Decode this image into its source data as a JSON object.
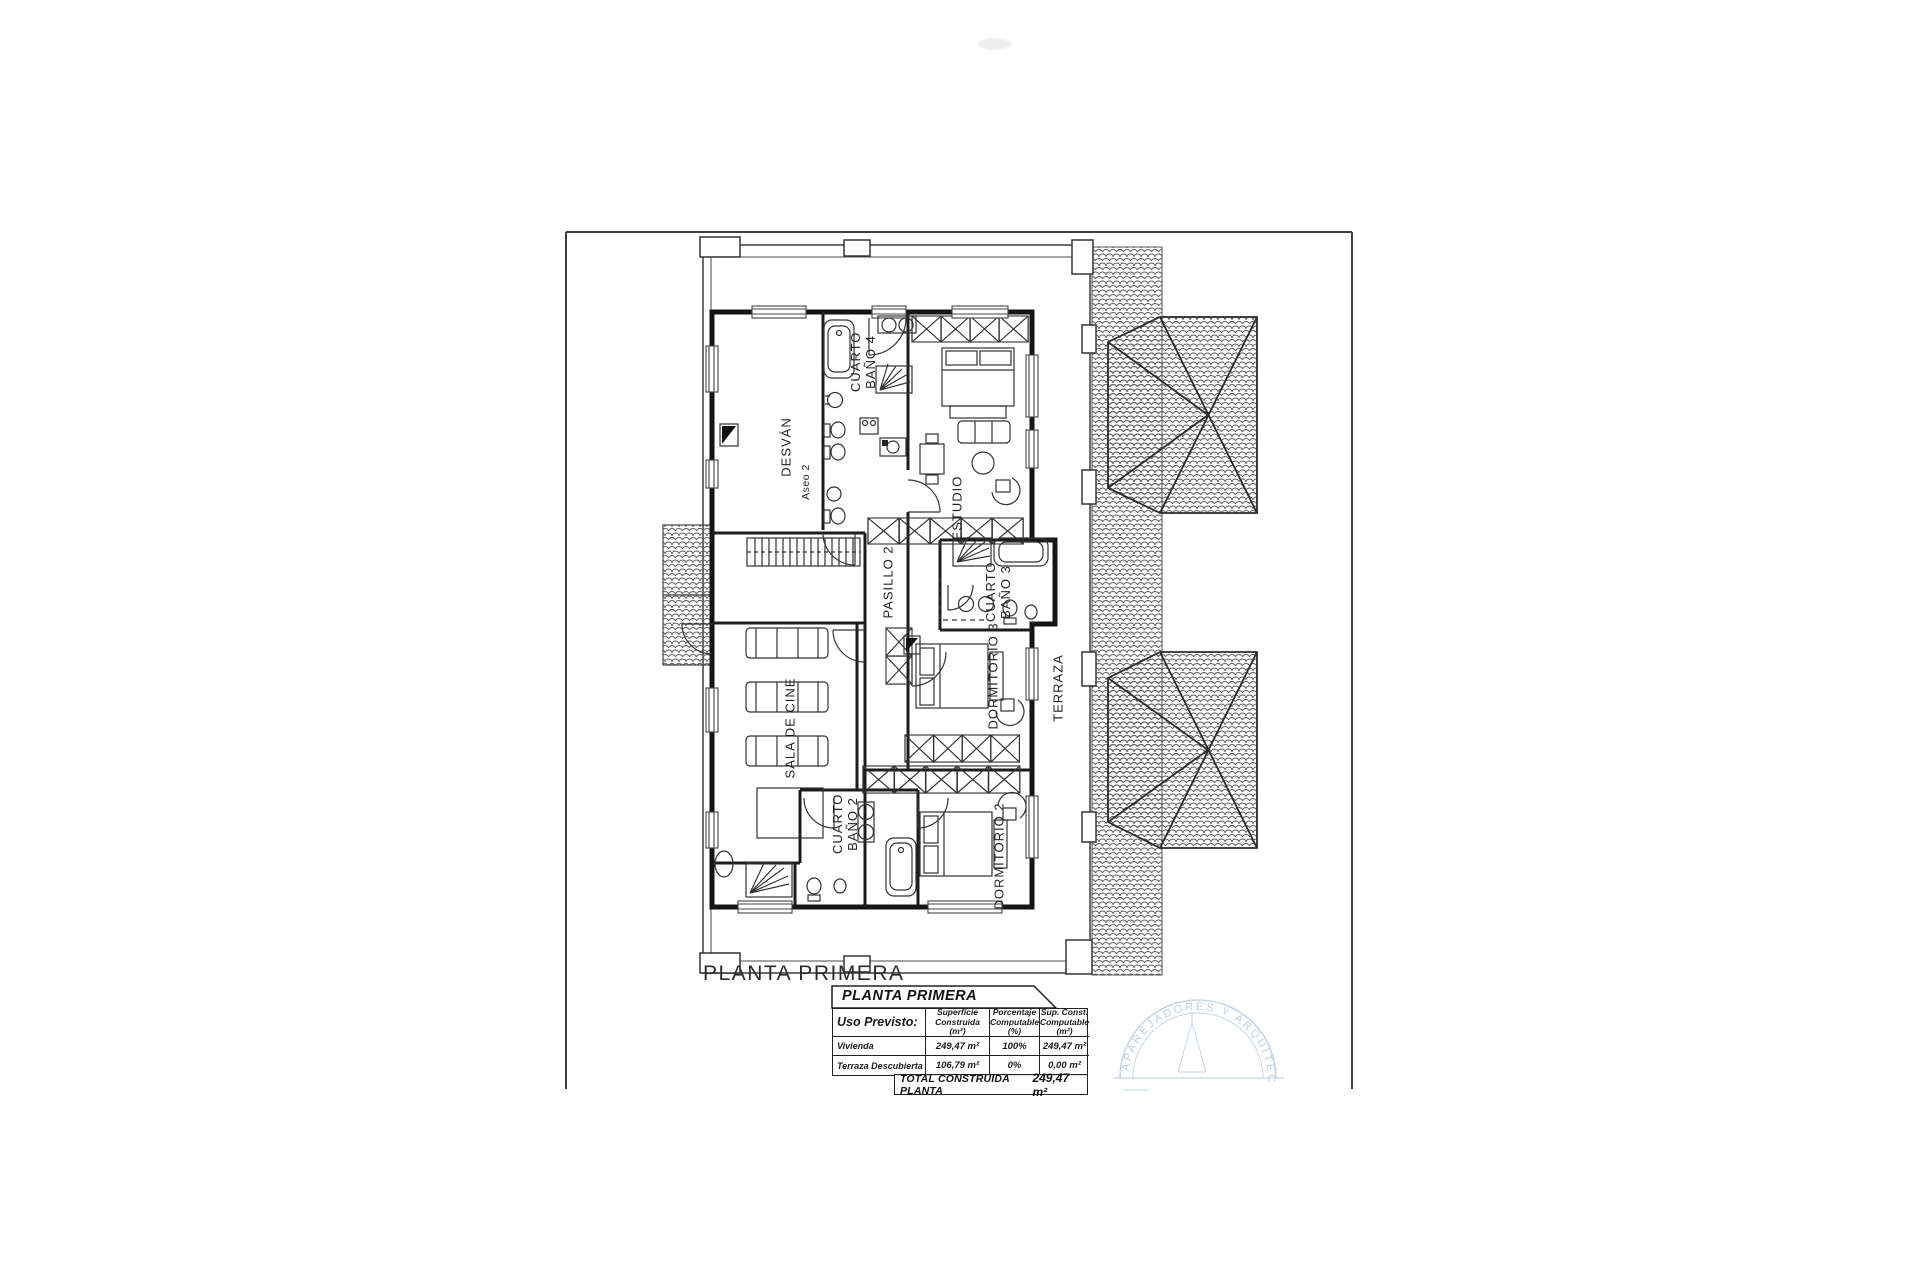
{
  "caption": "PLANTA PRIMERA",
  "rooms": {
    "desvan": "DESVÁN",
    "cuarto_bano_4": "CUARTO BAÑO 4",
    "aseo_2": "Aseo 2",
    "estudio": "ESTUDIO",
    "pasillo_2": "PASILLO 2",
    "cuarto_bano_3": "CUARTO BAÑO 3",
    "dormitorio_3": "DORMITORIO 3",
    "terraza": "TERRAZA",
    "sala_de_cine": "SALA DE CINE",
    "cuarto_bano_2": "CUARTO BAÑO 2",
    "dormitorio_2": "DORMITORIO 2"
  },
  "summary_table": {
    "title": "PLANTA PRIMERA",
    "col_headers": {
      "uso": "Uso Previsto:",
      "superficie": "Superficie Construida (m²)",
      "porcentaje": "Porcentaje Computable (%)",
      "sup_const": "Sup. Const. Computable (m²)"
    },
    "rows": [
      {
        "uso": "Vivienda",
        "superficie": "249,47 m²",
        "porcentaje": "100%",
        "sup_const": "249,47 m²"
      },
      {
        "uso": "Terraza Descubierta",
        "superficie": "106,79 m²",
        "porcentaje": "0%",
        "sup_const": "0,00 m²"
      }
    ],
    "total_label": "TOTAL CONSTRUIDA PLANTA",
    "total_value": "249,47 m²"
  },
  "stamp": {
    "arc_text": "APAREJADORES Y ARQUITECTOS",
    "color": "#a9c0d6"
  },
  "colors": {
    "ink": "#2e2e2e",
    "wall": "#151515",
    "paper": "#ffffff",
    "stamp": "#a9c0d6"
  }
}
